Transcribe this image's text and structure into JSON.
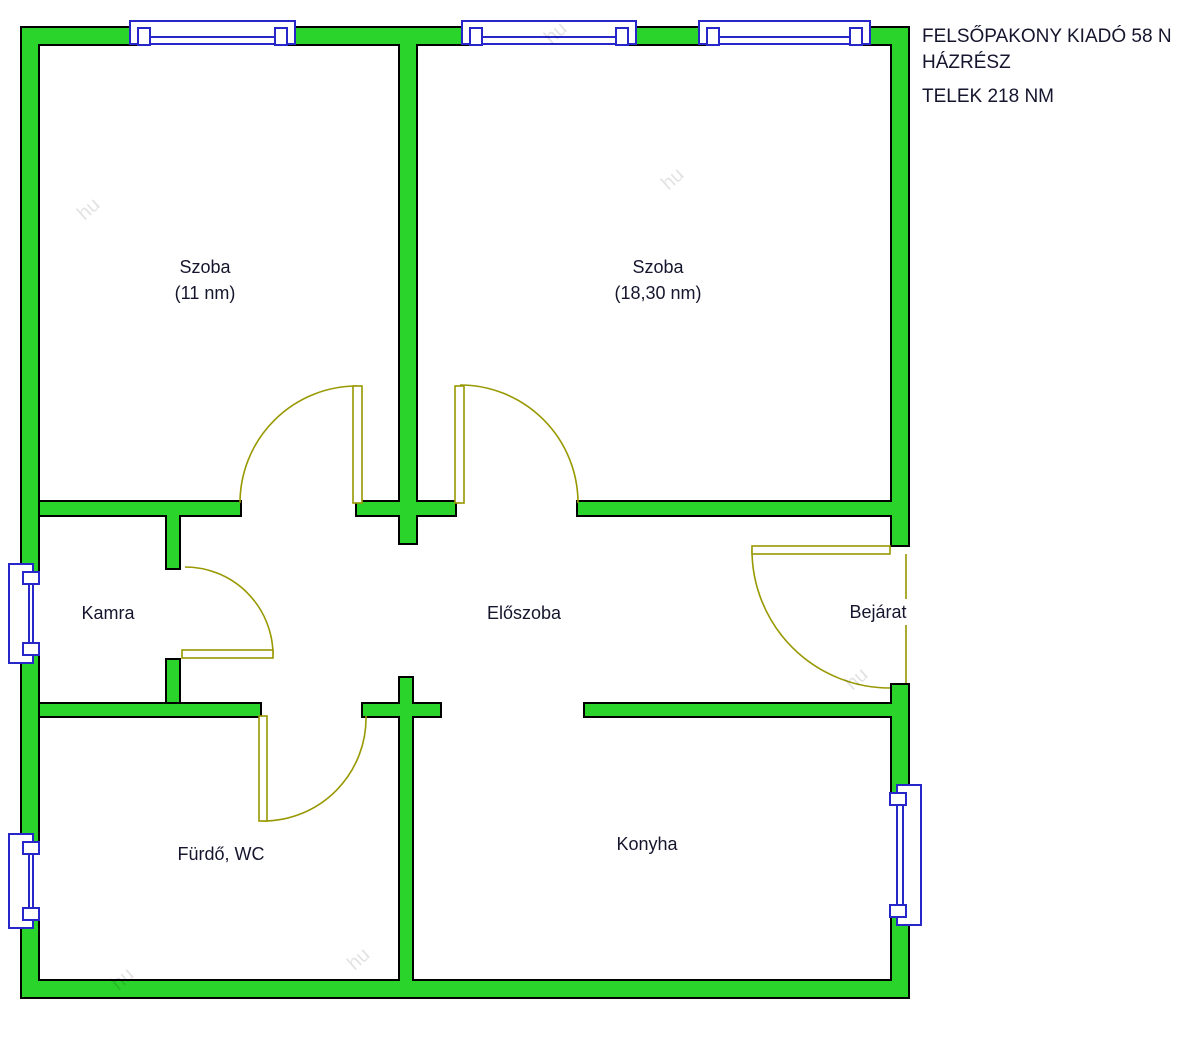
{
  "header": {
    "line1": "FELSŐPAKONY KIADÓ 58 N",
    "line2": "HÁZRÉSZ",
    "line3": "TELEK 218 NM"
  },
  "rooms": [
    {
      "name": "Szoba",
      "area": "(11 nm)"
    },
    {
      "name": "Szoba",
      "area": "(18,30 nm)"
    },
    {
      "name": "Kamra",
      "area": ""
    },
    {
      "name": "Előszoba",
      "area": ""
    },
    {
      "name": "Bejárat",
      "area": ""
    },
    {
      "name": "Fürdő, WC",
      "area": ""
    },
    {
      "name": "Konyha",
      "area": ""
    }
  ],
  "watermark": "hu",
  "colors": {
    "wall": "#2bd42b",
    "outline": "#000000",
    "window": "#2626c9",
    "door": "#989800",
    "text": "#15152e"
  }
}
